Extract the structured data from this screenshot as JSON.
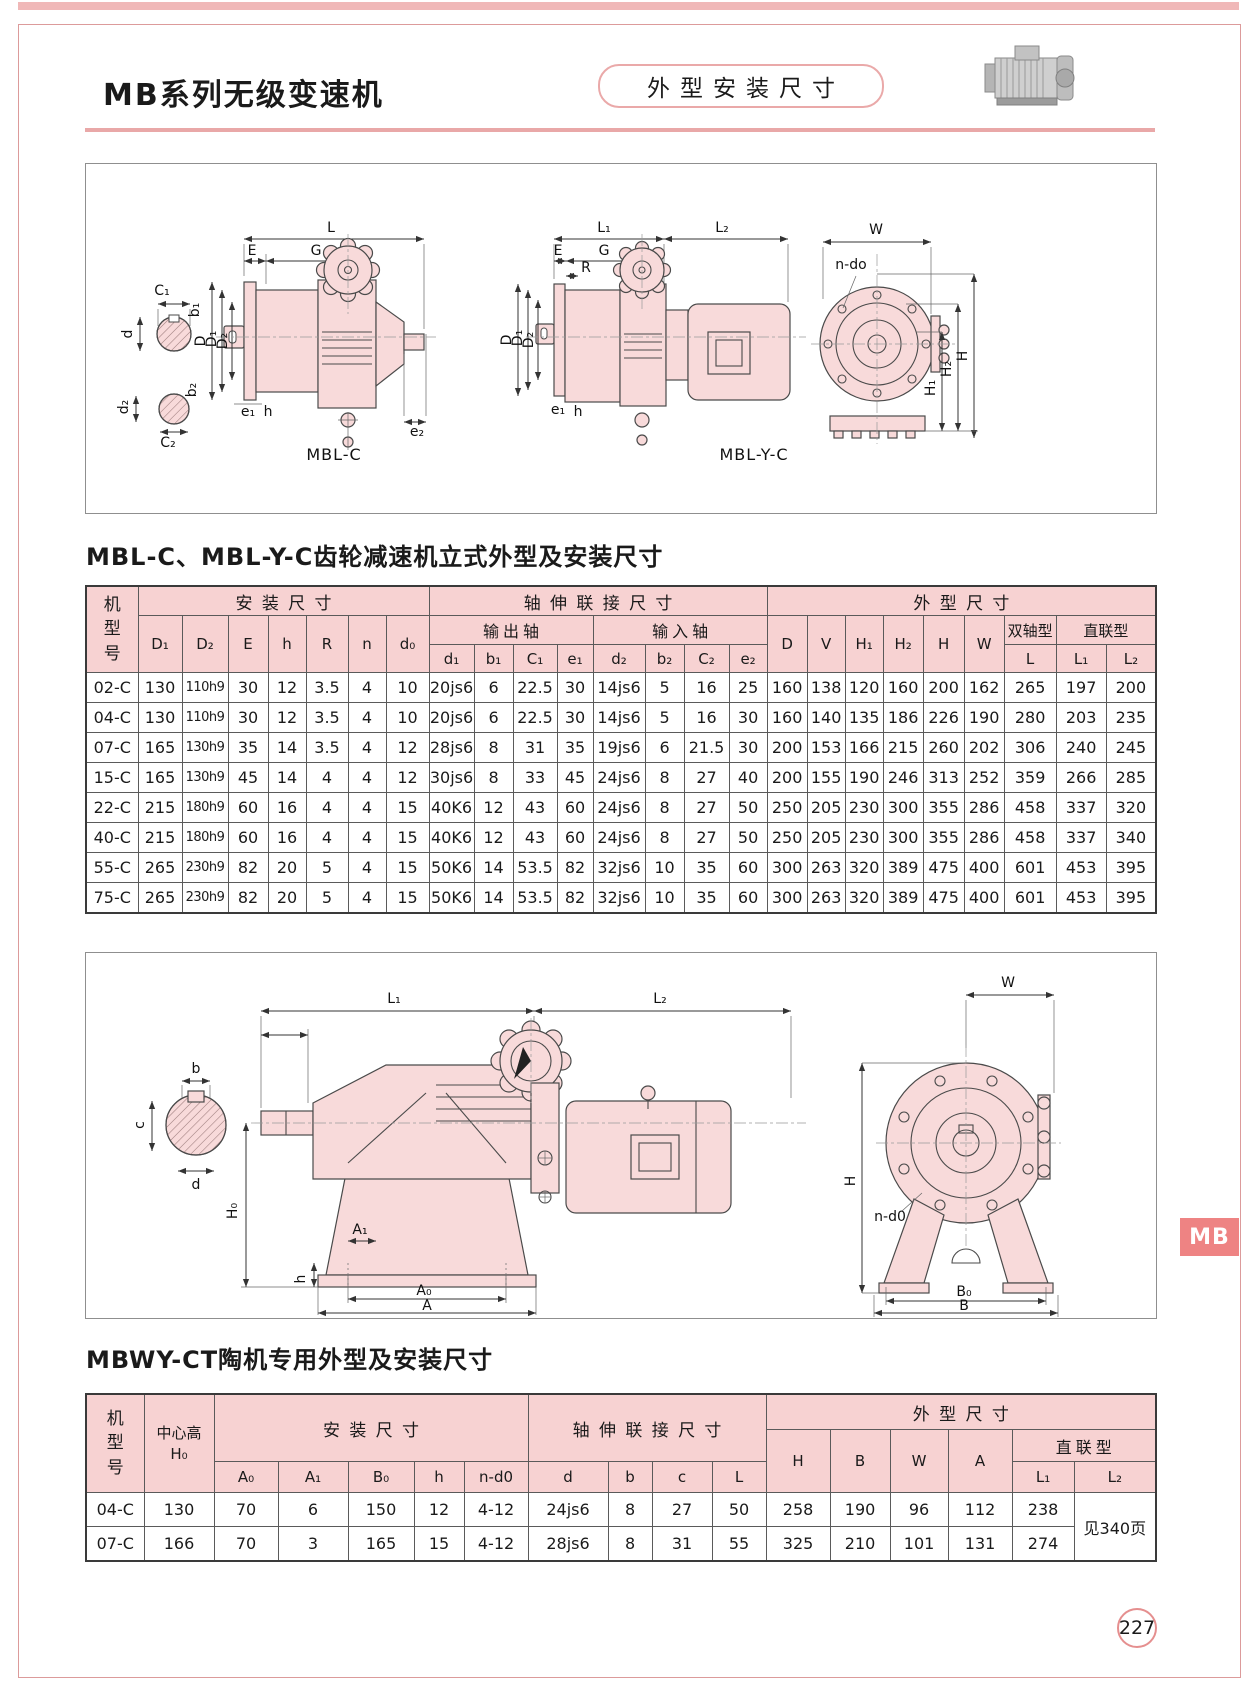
{
  "page": {
    "number": "227",
    "side_tab": "MB"
  },
  "colors": {
    "table_header_pink": "#f7d2d2",
    "frame_pink": "#dc9b9b",
    "top_band_pink": "#f0b8b8",
    "side_tab_red": "#ee8383",
    "drawing_fill_pink": "#f8dada",
    "rule_pink": "#e9a8a8"
  },
  "header": {
    "title": "MB系列无级变速机",
    "badge": "外型安装尺寸",
    "motor_icon": "motor-photo"
  },
  "fig1": {
    "caption_left": "MBL-C",
    "caption_right": "MBL-Y-C",
    "left": {
      "L": "L",
      "E": "E",
      "G": "G",
      "C1": "C₁",
      "b1": "b₁",
      "d": "d",
      "D": "D",
      "D1": "D₁",
      "D2": "D₂",
      "b2": "b₂",
      "d2": "d₂",
      "C2": "C₂",
      "e1": "e₁",
      "h": "h",
      "e2": "e₂"
    },
    "mid": {
      "L1": "L₁",
      "L2": "L₂",
      "E": "E",
      "G": "G",
      "R": "R",
      "D": "D",
      "D1": "D₁",
      "D2": "D₂",
      "e1": "e₁",
      "h": "h"
    },
    "right": {
      "W": "W",
      "ndo": "n-do",
      "H1": "H₁",
      "H2": "H₂",
      "H": "H"
    }
  },
  "table1": {
    "title": "MBL-C、MBL-Y-C齿轮减速机立式外型及安装尺寸",
    "header": {
      "model": "机型号",
      "install": "安装尺寸",
      "shaft": "轴伸联接尺寸",
      "outline": "外型尺寸",
      "output_shaft": "输出轴",
      "input_shaft": "输入轴",
      "double_shaft": "双轴型",
      "direct": "直联型",
      "install_cols": [
        "D₁",
        "D₂",
        "E",
        "h",
        "R",
        "n",
        "d₀"
      ],
      "output_cols": [
        "d₁",
        "b₁",
        "C₁",
        "e₁"
      ],
      "input_cols": [
        "d₂",
        "b₂",
        "C₂",
        "e₂"
      ],
      "outline_cols": [
        "D",
        "V",
        "H₁",
        "H₂",
        "H",
        "W"
      ],
      "L": "L",
      "L1": "L₁",
      "L2": "L₂"
    },
    "rows": [
      [
        "02-C",
        "130",
        "110h9",
        "30",
        "12",
        "3.5",
        "4",
        "10",
        "20js6",
        "6",
        "22.5",
        "30",
        "14js6",
        "5",
        "16",
        "25",
        "160",
        "138",
        "120",
        "160",
        "200",
        "162",
        "265",
        "197",
        "200"
      ],
      [
        "04-C",
        "130",
        "110h9",
        "30",
        "12",
        "3.5",
        "4",
        "10",
        "20js6",
        "6",
        "22.5",
        "30",
        "14js6",
        "5",
        "16",
        "30",
        "160",
        "140",
        "135",
        "186",
        "226",
        "190",
        "280",
        "203",
        "235"
      ],
      [
        "07-C",
        "165",
        "130h9",
        "35",
        "14",
        "3.5",
        "4",
        "12",
        "28js6",
        "8",
        "31",
        "35",
        "19js6",
        "6",
        "21.5",
        "30",
        "200",
        "153",
        "166",
        "215",
        "260",
        "202",
        "306",
        "240",
        "245"
      ],
      [
        "15-C",
        "165",
        "130h9",
        "45",
        "14",
        "4",
        "4",
        "12",
        "30js6",
        "8",
        "33",
        "45",
        "24js6",
        "8",
        "27",
        "40",
        "200",
        "155",
        "190",
        "246",
        "313",
        "252",
        "359",
        "266",
        "285"
      ],
      [
        "22-C",
        "215",
        "180h9",
        "60",
        "16",
        "4",
        "4",
        "15",
        "40K6",
        "12",
        "43",
        "60",
        "24js6",
        "8",
        "27",
        "50",
        "250",
        "205",
        "230",
        "300",
        "355",
        "286",
        "458",
        "337",
        "320"
      ],
      [
        "40-C",
        "215",
        "180h9",
        "60",
        "16",
        "4",
        "4",
        "15",
        "40K6",
        "12",
        "43",
        "60",
        "24js6",
        "8",
        "27",
        "50",
        "250",
        "205",
        "230",
        "300",
        "355",
        "286",
        "458",
        "337",
        "340"
      ],
      [
        "55-C",
        "265",
        "230h9",
        "82",
        "20",
        "5",
        "4",
        "15",
        "50K6",
        "14",
        "53.5",
        "82",
        "32js6",
        "10",
        "35",
        "60",
        "300",
        "263",
        "320",
        "389",
        "475",
        "400",
        "601",
        "453",
        "395"
      ],
      [
        "75-C",
        "265",
        "230h9",
        "82",
        "20",
        "5",
        "4",
        "15",
        "50K6",
        "14",
        "53.5",
        "82",
        "32js6",
        "10",
        "35",
        "60",
        "300",
        "263",
        "320",
        "389",
        "475",
        "400",
        "601",
        "453",
        "395"
      ]
    ]
  },
  "fig2": {
    "left": {
      "b": "b",
      "c": "c",
      "d": "d"
    },
    "mid": {
      "L1": "L₁",
      "L2": "L₂",
      "H0": "H₀",
      "A1": "A₁",
      "h": "h",
      "A0": "A₀",
      "A": "A"
    },
    "right": {
      "W": "W",
      "H": "H",
      "nd0": "n-d0",
      "B0": "B₀",
      "B": "B"
    }
  },
  "table2": {
    "title": "MBWY-CT陶机专用外型及安装尺寸",
    "header": {
      "model": "机型号",
      "center_height": "中心高",
      "center_height_symbol": "H₀",
      "install": "安装尺寸",
      "shaft": "轴伸联接尺寸",
      "outline": "外型尺寸",
      "direct": "直联型",
      "install_cols": [
        "A₀",
        "A₁",
        "B₀",
        "h",
        "n-d0"
      ],
      "shaft_cols": [
        "d",
        "b",
        "c",
        "L"
      ],
      "outline_cols": [
        "H",
        "B",
        "W",
        "A"
      ],
      "L1": "L₁",
      "L2": "L₂"
    },
    "rows": [
      [
        "04-C",
        "130",
        "70",
        "6",
        "150",
        "12",
        "4-12",
        "24js6",
        "8",
        "27",
        "50",
        "258",
        "190",
        "96",
        "112",
        "238"
      ],
      [
        "07-C",
        "166",
        "70",
        "3",
        "165",
        "15",
        "4-12",
        "28js6",
        "8",
        "31",
        "55",
        "325",
        "210",
        "101",
        "131",
        "274"
      ]
    ],
    "l2_note": "见340页"
  }
}
